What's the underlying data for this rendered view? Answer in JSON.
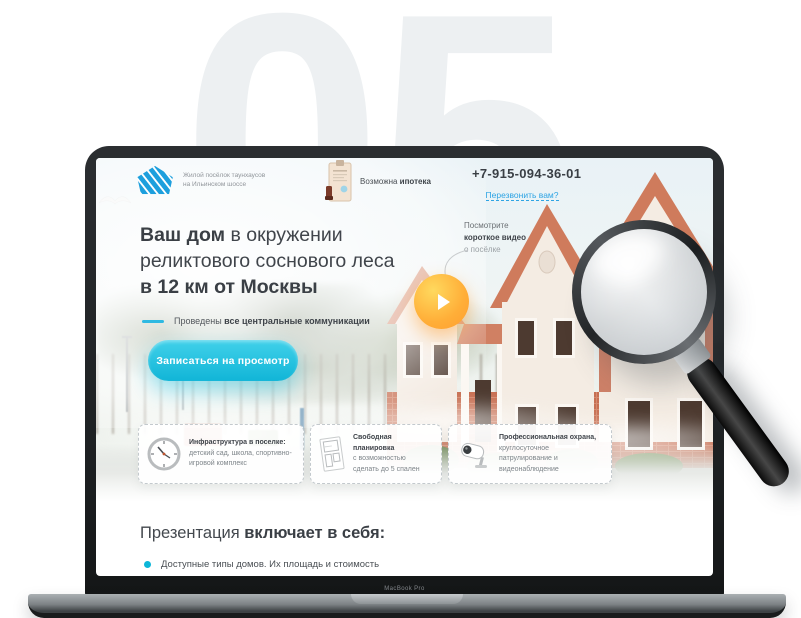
{
  "page": {
    "slide_number": "05",
    "device_label": "MacBook Pro"
  },
  "site": {
    "logo": {
      "line1": "Жилой посёлок таунхаусов",
      "line2": "на Ильинском шоссе"
    },
    "mortgage": {
      "prefix": "Возможна ",
      "bold": "ипотека"
    },
    "phone": "+7-915-094-36-01",
    "callback_link": "Перезвонить вам?",
    "headline": {
      "bold1": "Ваш дом",
      "rest1": " в окружении",
      "line2": "реликтового соснового леса",
      "line3": "в 12 км от Москвы"
    },
    "communications": {
      "prefix": "Проведены ",
      "bold": "все центральные коммуникации"
    },
    "cta_label": "Записаться на просмотр",
    "video": {
      "line1": "Посмотрите",
      "line2": "короткое видео",
      "line3": "о посёлке"
    },
    "features": [
      {
        "icon": "clock-icon",
        "title": "Инфраструктура в поселке:",
        "text": "детский сад, школа, спортивно-игровой комплекс"
      },
      {
        "icon": "floor-plan-icon",
        "title": "Свободная планировка",
        "text": "с возможностью сделать до 5 спален"
      },
      {
        "icon": "security-camera-icon",
        "title": "Профессиональная охрана,",
        "text": "круглосуточное патрулирование и видеонаблюдение"
      }
    ],
    "presentation": {
      "prefix": "Презентация ",
      "bold": "включает в себя:",
      "items": [
        "Доступные типы домов. Их площадь и стоимость"
      ]
    },
    "colors": {
      "accent_cyan": "#1fc1e0",
      "link_blue": "#2ea4e4",
      "play_orange": "#ffae38",
      "logo_blue": "#1d9fdd"
    }
  }
}
